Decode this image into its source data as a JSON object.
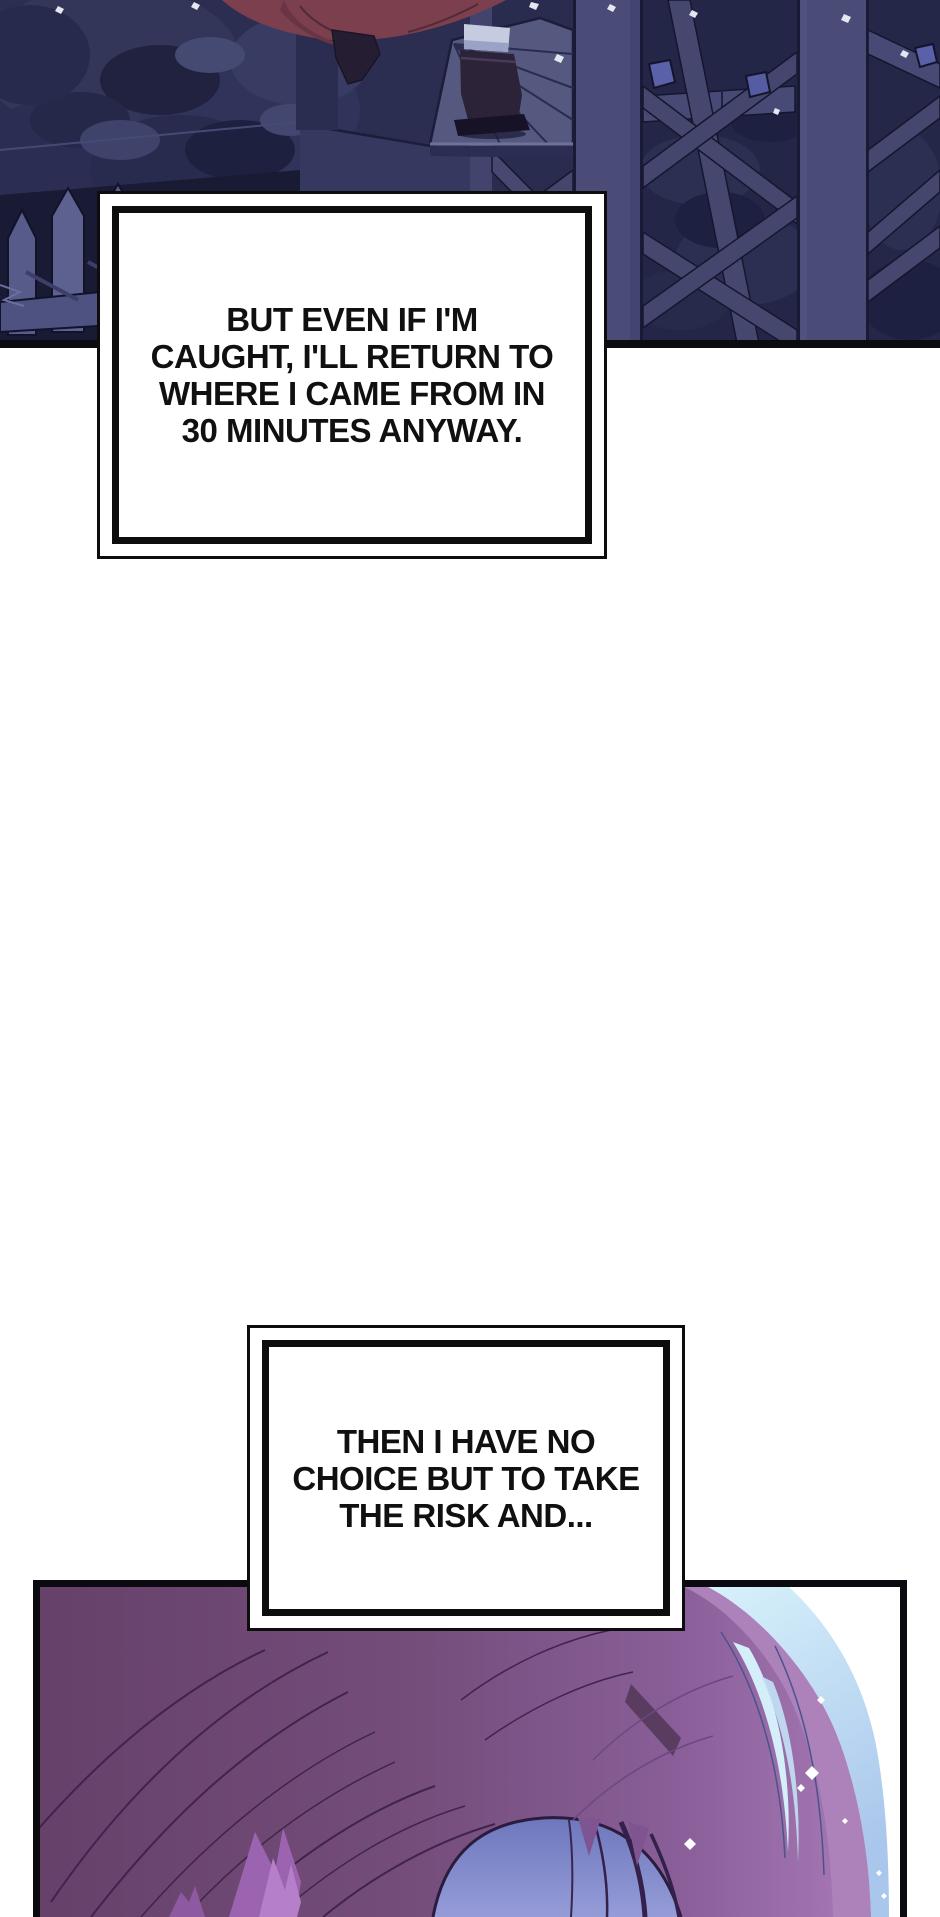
{
  "page": {
    "kind": "comic page",
    "background": "#ffffff",
    "width": 940,
    "height": 1917
  },
  "speech_boxes": [
    {
      "id": "caption-top",
      "lines": [
        "BUT EVEN IF I'M",
        "CAUGHT, I'LL RETURN TO",
        "WHERE I CAME FROM IN",
        "30 MINUTES ANYWAY."
      ]
    },
    {
      "id": "caption-bottom",
      "lines": [
        "THEN I HAVE NO",
        "CHOICE BUT TO TAKE",
        "THE RISK AND..."
      ]
    }
  ],
  "panels": {
    "top": {
      "description": "night scene: character in dark red skirt and boots climbing a wooden cross-braced fence beside dark foliage and picket stakes",
      "colors": {
        "background": "#2c2e51",
        "beam": "#4a4c77",
        "beam_line": "#15162e",
        "foliage_dark": "#20223f",
        "foliage_mid": "#333659",
        "skirt_red": "#7c3f4e",
        "boot_dark": "#2c2339",
        "stocking": "#c5cce0",
        "fence_stake": "#575b8a",
        "gem_blue": "#5a61a8",
        "border": "#0b0b12"
      }
    },
    "bottom": {
      "description": "close-up of the top of a head of long pink-purple hair with a cyan rim highlight against white, blue gap below",
      "colors": {
        "hair_dark": "#654169",
        "hair_mid": "#8a5f9a",
        "hair_light": "#a87ab6",
        "cyan_highlight": "#d9f3fb",
        "cyan_shade": "#a9c6ec",
        "arch_blue": "#959cd8",
        "strand_line": "#40244b",
        "streak_purple": "#9c64b0",
        "sparkle": "#ffffff",
        "border": "#0a0a10"
      }
    }
  }
}
